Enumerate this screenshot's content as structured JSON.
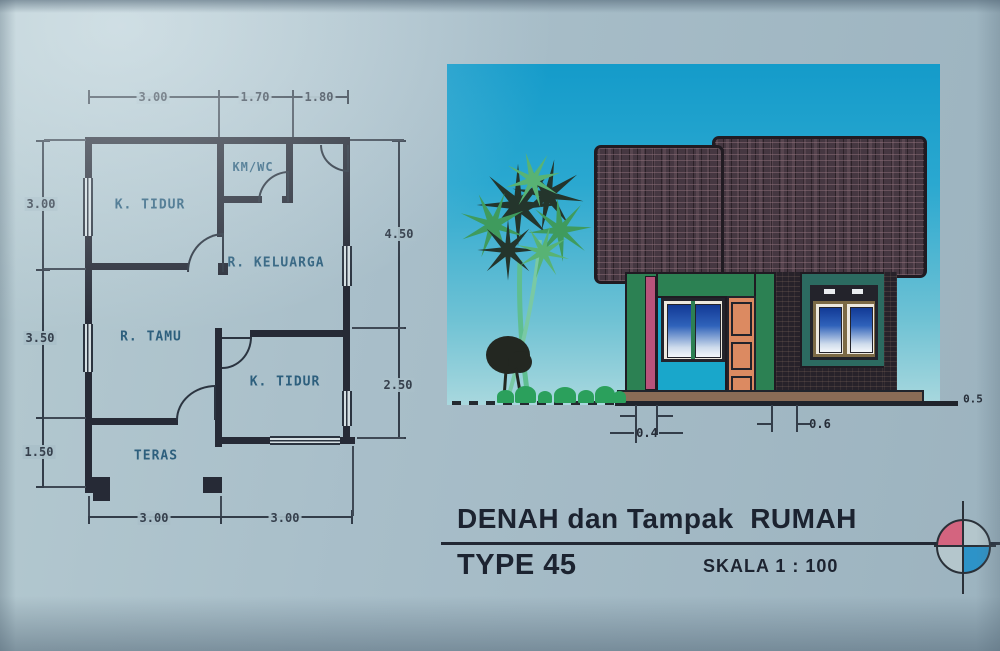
{
  "paper": {
    "bg": "#a9bfc9"
  },
  "floor_plan": {
    "rooms": [
      {
        "label": "K. TIDUR"
      },
      {
        "label": "KM/WC"
      },
      {
        "label": "R. KELUARGA"
      },
      {
        "label": "R. TAMU"
      },
      {
        "label": "K. TIDUR"
      },
      {
        "label": "TERAS"
      }
    ],
    "dimensions": {
      "top": [
        "3.00",
        "1.70",
        "1.80"
      ],
      "left": [
        "3.00",
        "3.50",
        "1.50"
      ],
      "right": [
        "4.50",
        "2.50"
      ],
      "bottom": [
        "3.00",
        "3.00"
      ]
    }
  },
  "elevation": {
    "dimension_labels": {
      "porch_offset": "0.4",
      "side_offset": "0.6",
      "ground_right": "0.5"
    },
    "colors": {
      "sky_top": "#149bca",
      "sky_bottom": "#a9d8de",
      "roof": "#453741",
      "wall_green": "#2c8153",
      "wall_teal": "#2c6b61",
      "wall_cyan": "#19a7cb",
      "door": "#dc8a61",
      "accent_pink": "#b9537b",
      "base": "#8a6c56",
      "foliage": "#2ba05c"
    }
  },
  "title_block": {
    "title": "DENAH dan Tampak  RUMAH",
    "subtitle": "TYPE 45",
    "scale_label": "SKALA 1 : 100"
  },
  "compass": {
    "color_top_left": "#d4647f",
    "color_bottom_right": "#2d93c8"
  }
}
